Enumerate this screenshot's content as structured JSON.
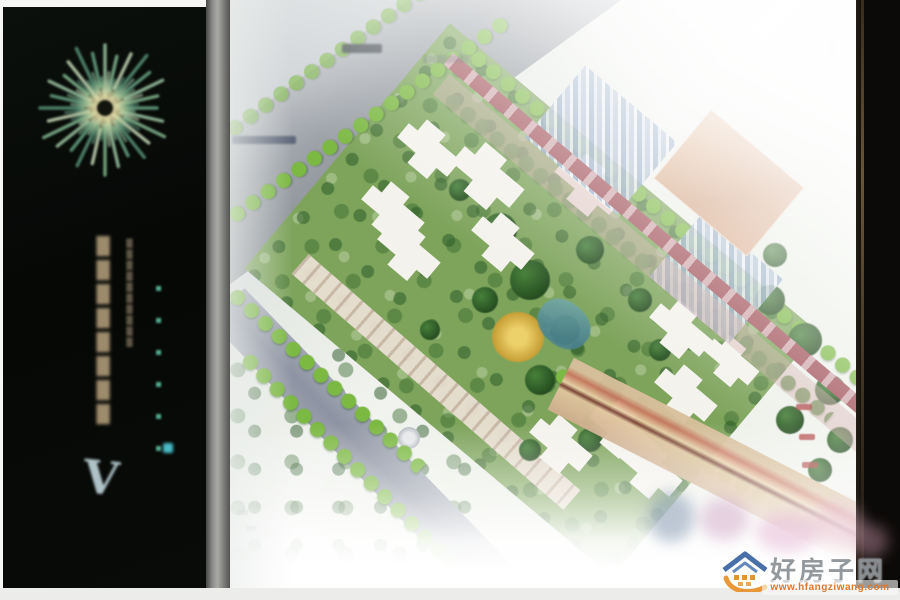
{
  "left_panel": {
    "logo_icon": "starburst-dandelion-logo",
    "background_color": "#070a08",
    "vertical_tagline_illegible": "████████",
    "vertical_tagline_secondary_illegible": "██████████",
    "vertical_accent_marks_illegible": "▪▪▪▪▪▪",
    "v_mark": "V",
    "tagline_color": "#a59272",
    "accent_color": "#4fae92"
  },
  "site_plan": {
    "kind": "residential-master-plan-rendering",
    "colors": {
      "grass": "#7ea45c",
      "road_grey": "#9ea3a9",
      "boundary_road_red": "#a2525a",
      "tree_bright_green": "#7cb943",
      "tree_dark_green": "#2e5e2a",
      "building_white": "#f4f2ec",
      "central_plaza_gold": "#d8b23f",
      "pond_teal": "#5d98a0",
      "plaza_tan": "#d8ab87",
      "parking_blue": "#8aa2c2"
    }
  },
  "watermark": {
    "logo_icon": "house-roof-swoosh-logo",
    "site_name": "好房子网",
    "url": "www.hfangziwang.com",
    "name_color": "#85898d",
    "url_color": "#e0762a",
    "roof_color": "#345f9e",
    "swoosh_color": "#e8932c"
  }
}
